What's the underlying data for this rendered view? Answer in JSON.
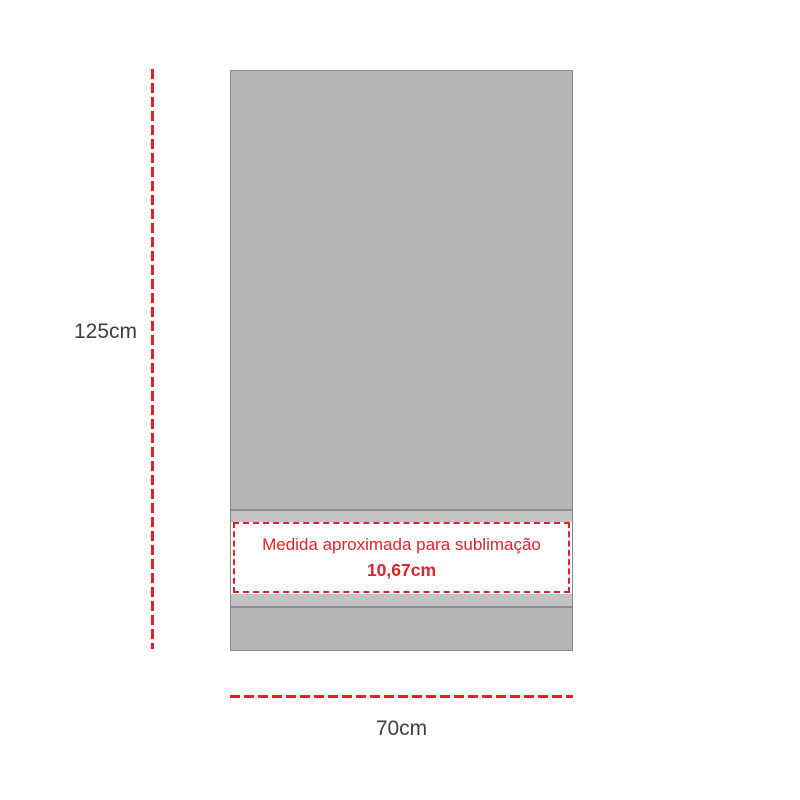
{
  "colors": {
    "background": "#ffffff",
    "accent_red": "#e02127",
    "band_text_red": "#d9252b",
    "towel_gray": "#b6b6b6",
    "trim_gray": "#c3c3c3",
    "stitch_gray": "#8f8f8f",
    "towel_border_gray": "#8a8a8a",
    "label_gray": "#3f3f3f",
    "band_white": "#ffffff"
  },
  "diagram": {
    "height_label": "125cm",
    "width_label": "70cm",
    "band": {
      "note": "Medida aproximada para sublimação",
      "measure": "10,67cm"
    }
  }
}
